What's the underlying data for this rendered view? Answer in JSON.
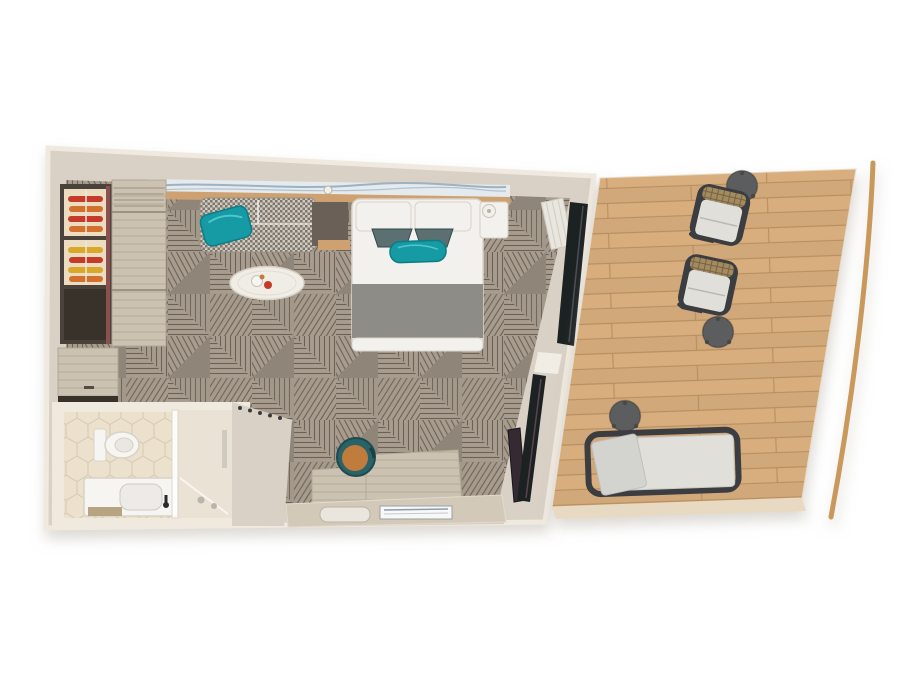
{
  "scene": {
    "type": "floor-plan",
    "areas": {
      "cabin": {
        "name": "cabin",
        "furniture": [
          "double-bed",
          "sofa",
          "coffee-table",
          "wardrobe",
          "open-shelf-unit",
          "desk",
          "desk-chair",
          "tv-panel",
          "nightstand",
          "wall-art",
          "sliding-glass-doors"
        ]
      },
      "bathroom": {
        "name": "bathroom",
        "furniture": [
          "toilet",
          "vanity-sink",
          "shower"
        ]
      },
      "entry": {
        "name": "entry",
        "furniture": [
          "coat-hooks"
        ]
      },
      "balcony": {
        "name": "balcony",
        "furniture": [
          "armchair",
          "armchair",
          "side-table",
          "side-table",
          "side-table",
          "sun-lounger",
          "railing"
        ]
      }
    }
  },
  "colors": {
    "bg": "#ffffff",
    "wall": "#d9d1c5",
    "wall-outer": "#efe9e0",
    "carpet-base": "#8f8579",
    "carpet-mid": "#a79c8e",
    "carpet-line": "#574e44",
    "deck-base": "#d8ae7e",
    "deck-seam": "#b2885a",
    "deck-edge": "#e8d9c2",
    "railing": "#c9995c",
    "art-bg": "#e4eaee",
    "art-wave": "#9db2c2",
    "wood-ledge": "#cda26f",
    "furniture-white": "#f3f1ed",
    "fixture-stroke": "#d3ccc1",
    "bed-runner": "#8e8c87",
    "teal": "#129ba4",
    "accent-pillow": "#5c6f72",
    "sofa-base": "#cecbc4",
    "sofa-check": "#7f7568",
    "greige-wood": "#cbc2b1",
    "grain-line": "#a29886",
    "wardrobe-frame": "#4b433b",
    "cubby-dark": "#38322c",
    "shelf-cream": "#ecdcc0",
    "clothes-red": "#c43a2c",
    "clothes-orange": "#d2702e",
    "clothes-yellow": "#d9a72c",
    "maroon-edge": "#8b5150",
    "marble": "#f0ede6",
    "console-dark": "#6b6158",
    "chair-teal": "#2b6267",
    "chair-seat": "#c07b3d",
    "frame-dark": "#3a3d3f",
    "cushion": "#e0dfda",
    "wicker": "#a48a5e",
    "side-table": "#5b5d5e",
    "window-dark": "#1f2124",
    "tv-dark": "#342a31",
    "bath-wall": "#f0eade",
    "bath-floor": "#ebe1cd",
    "hex-line": "#d7c9b1",
    "fixture-white": "#f6f5f2",
    "faucet": "#2b2b2b",
    "entry-floor": "#d7cec0",
    "desk-wood": "#d3c9b9",
    "mat-wood": "#b7a483",
    "lamp": "#f1efe9"
  }
}
